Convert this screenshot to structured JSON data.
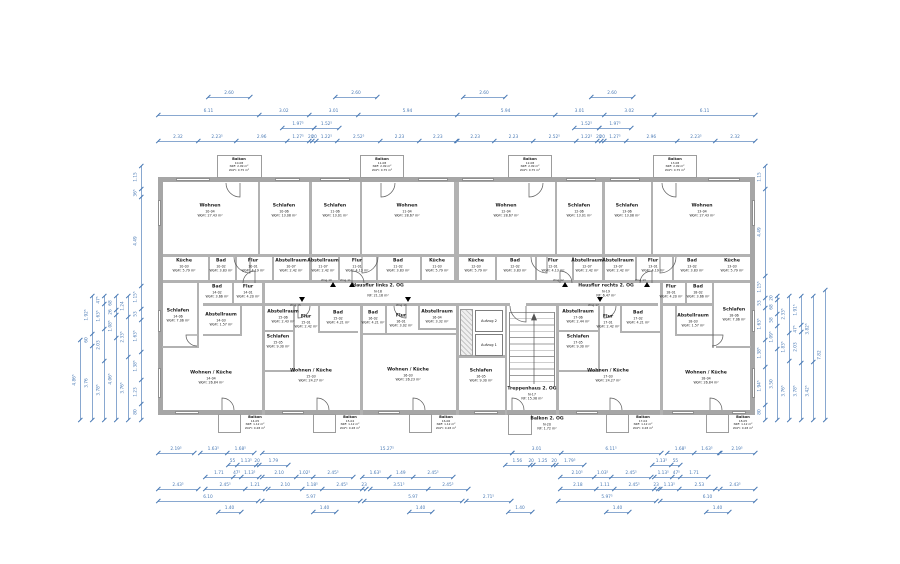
{
  "floor": "2. OG",
  "colors": {
    "dimension_blue": "#4a7ab5",
    "wall_gray": "#b2b2b2",
    "text_black": "#1b1b1b"
  },
  "elevators": {
    "top": "Aufzug 2",
    "bottom": "Aufzug 1"
  },
  "entrances": [
    "Wng 10",
    "Wng 11",
    "Wng 12",
    "Wng 13",
    "Wng 15",
    "Wng 16",
    "Wng 17"
  ],
  "rooms": [
    {
      "id": "w10",
      "name": "Wohnen",
      "no": "10-04",
      "area": "WoFl: 27.43 m²"
    },
    {
      "id": "s10",
      "name": "Schlafen",
      "no": "10-06",
      "area": "WoFl: 13.08 m²"
    },
    {
      "id": "k10",
      "name": "Küche",
      "no": "10-03",
      "area": "WoFl: 5.79 m²"
    },
    {
      "id": "b10",
      "name": "Bad",
      "no": "10-02",
      "area": "WoFl: 3.83 m²"
    },
    {
      "id": "f10",
      "name": "Flur",
      "no": "10-01",
      "area": "WoFl: 4.19 m²"
    },
    {
      "id": "a10",
      "name": "Abstellraum",
      "no": "10-07",
      "area": "WoFl: 2.42 m²"
    },
    {
      "id": "balt10",
      "name": "Balkon",
      "no": "10-08",
      "area": "NRF: 2.99 m²",
      "area2": "WoFl: 0.75 m²"
    },
    {
      "id": "s11",
      "name": "Schlafen",
      "no": "11-06",
      "area": "WoFl: 13.01 m²"
    },
    {
      "id": "w11",
      "name": "Wohnen",
      "no": "11-04",
      "area": "WoFl: 28.67 m²"
    },
    {
      "id": "a11",
      "name": "Abstellraum",
      "no": "11-07",
      "area": "WoFl: 2.42 m²"
    },
    {
      "id": "f11",
      "name": "Flur",
      "no": "11-01",
      "area": "WoFl: 4.13 m²"
    },
    {
      "id": "b11",
      "name": "Bad",
      "no": "11-02",
      "area": "WoFl: 3.83 m²"
    },
    {
      "id": "k11",
      "name": "Küche",
      "no": "11-03",
      "area": "WoFl: 5.79 m²"
    },
    {
      "id": "balt11",
      "name": "Balkon",
      "no": "11-08",
      "area": "NRF: 2.99 m²",
      "area2": "WoFl: 0.75 m²"
    },
    {
      "id": "w12",
      "name": "Wohnen",
      "no": "12-04",
      "area": "WoFl: 28.67 m²"
    },
    {
      "id": "s12",
      "name": "Schlafen",
      "no": "12-06",
      "area": "WoFl: 13.01 m²"
    },
    {
      "id": "k12",
      "name": "Küche",
      "no": "12-03",
      "area": "WoFl: 5.79 m²"
    },
    {
      "id": "b12",
      "name": "Bad",
      "no": "12-02",
      "area": "WoFl: 3.83 m²"
    },
    {
      "id": "f12",
      "name": "Flur",
      "no": "12-01",
      "area": "WoFl: 4.13 m²"
    },
    {
      "id": "a12",
      "name": "Abstellraum",
      "no": "12-07",
      "area": "WoFl: 2.42 m²"
    },
    {
      "id": "balt12",
      "name": "Balkon",
      "no": "12-08",
      "area": "NRF: 2.99 m²",
      "area2": "WoFl: 0.75 m²"
    },
    {
      "id": "s13",
      "name": "Schlafen",
      "no": "13-06",
      "area": "WoFl: 13.08 m²"
    },
    {
      "id": "w13",
      "name": "Wohnen",
      "no": "13-04",
      "area": "WoFl: 27.43 m²"
    },
    {
      "id": "a13",
      "name": "Abstellraum",
      "no": "13-07",
      "area": "WoFl: 2.42 m²"
    },
    {
      "id": "f13",
      "name": "Flur",
      "no": "13-01",
      "area": "WoFl: 4.19 m²"
    },
    {
      "id": "b13",
      "name": "Bad",
      "no": "13-02",
      "area": "WoFl: 3.83 m²"
    },
    {
      "id": "k13",
      "name": "Küche",
      "no": "13-03",
      "area": "WoFl: 5.79 m²"
    },
    {
      "id": "balt13",
      "name": "Balkon",
      "no": "13-08",
      "area": "NRF: 2.99 m²",
      "area2": "WoFl: 0.75 m²"
    },
    {
      "id": "s14",
      "name": "Schlafen",
      "no": "14-06",
      "area": "WoFl: 7.06 m²"
    },
    {
      "id": "b14",
      "name": "Bad",
      "no": "14-02",
      "area": "WoFl: 3.66 m²"
    },
    {
      "id": "f14",
      "name": "Flur",
      "no": "14-01",
      "area": "WoFl: 4.20 m²"
    },
    {
      "id": "a14",
      "name": "Abstellraum",
      "no": "14-03",
      "area": "WoFl: 1.57 m²"
    },
    {
      "id": "wk14",
      "name": "Wohnen / Küche",
      "no": "14-04",
      "area": "WoFl: 26.84 m²"
    },
    {
      "id": "balb14",
      "name": "Balkon",
      "no": "14-05",
      "area": "NRF: 1.12 m²",
      "area2": "WoFl: 0.28 m²"
    },
    {
      "id": "a15",
      "name": "Abstellraum",
      "no": "15-06",
      "area": "WoFl: 2.43 m²"
    },
    {
      "id": "f15",
      "name": "Flur",
      "no": "15-01",
      "area": "WoFl: 2.42 m²"
    },
    {
      "id": "b15",
      "name": "Bad",
      "no": "15-02",
      "area": "WoFl: 4.21 m²"
    },
    {
      "id": "s15",
      "name": "Schlafen",
      "no": "15-05",
      "area": "WoFl: 9.30 m²"
    },
    {
      "id": "wk15",
      "name": "Wohnen / Küche",
      "no": "15-03",
      "area": "WoFl: 24.27 m²"
    },
    {
      "id": "balb15",
      "name": "Balkon",
      "no": "15-04",
      "area": "NRF: 1.12 m²",
      "area2": "WoFl: 0.28 m²"
    },
    {
      "id": "b16",
      "name": "Bad",
      "no": "16-02",
      "area": "WoFl: 4.21 m²"
    },
    {
      "id": "f16",
      "name": "Flur",
      "no": "16-01",
      "area": "WoFl: 3.02 m²"
    },
    {
      "id": "a16",
      "name": "Abstellraum",
      "no": "16-04",
      "area": "WoFl: 3.32 m²"
    },
    {
      "id": "wk16",
      "name": "Wohnen / Küche",
      "no": "16-03",
      "area": "WoFl: 26.23 m²"
    },
    {
      "id": "s16",
      "name": "Schlafen",
      "no": "16-05",
      "area": "WoFl: 9.30 m²"
    },
    {
      "id": "balb16",
      "name": "Balkon",
      "no": "16-06",
      "area": "NRF: 1.12 m²",
      "area2": "WoFl: 0.28 m²"
    },
    {
      "id": "a17",
      "name": "Abstellraum",
      "no": "17-06",
      "area": "WoFl: 2.44 m²"
    },
    {
      "id": "f17",
      "name": "Flur",
      "no": "17-01",
      "area": "WoFl: 2.42 m²"
    },
    {
      "id": "b17",
      "name": "Bad",
      "no": "17-02",
      "area": "WoFl: 4.21 m²"
    },
    {
      "id": "s17",
      "name": "Schlafen",
      "no": "17-05",
      "area": "WoFl: 9.30 m²"
    },
    {
      "id": "wk17",
      "name": "Wohnen / Küche",
      "no": "17-03",
      "area": "WoFl: 24.27 m²"
    },
    {
      "id": "balb17",
      "name": "Balkon",
      "no": "17-04",
      "area": "NRF: 1.12 m²",
      "area2": "WoFl: 0.28 m²"
    },
    {
      "id": "f18",
      "name": "Flur",
      "no": "18-01",
      "area": "WoFl: 4.20 m²"
    },
    {
      "id": "b18",
      "name": "Bad",
      "no": "18-02",
      "area": "WoFl: 3.66 m²"
    },
    {
      "id": "a18",
      "name": "Abstellraum",
      "no": "18-03",
      "area": "WoFl: 1.57 m²"
    },
    {
      "id": "s18",
      "name": "Schlafen",
      "no": "18-06",
      "area": "WoFl: 7.06 m²"
    },
    {
      "id": "wk18",
      "name": "Wohnen / Küche",
      "no": "18-04",
      "area": "WoFl: 26.84 m²"
    },
    {
      "id": "balb18",
      "name": "Balkon",
      "no": "18-05",
      "area": "NRF: 1.12 m²",
      "area2": "WoFl: 0.28 m²"
    },
    {
      "id": "hfl",
      "name": "Hausflur links 2. OG",
      "no": "N-18",
      "area": "NF: 21.16 m²"
    },
    {
      "id": "hfr",
      "name": "Hausflur rechts 2. OG",
      "no": "N-19",
      "area": "NF: 6.47 m²"
    },
    {
      "id": "tr",
      "name": "Treppenhaus 2. OG",
      "no": "N-17",
      "area": "NF: 15.38 m²"
    },
    {
      "id": "b2og",
      "name": "Balkon 2. OG",
      "no": "N-20",
      "area": "NF: 1.72 m²"
    }
  ],
  "dimensions": {
    "top": [
      [
        "2.60"
      ],
      [
        "2.60"
      ],
      [
        "2.60"
      ],
      [
        "2.60"
      ],
      [
        "6.11",
        "3.02",
        "3.01",
        "5.94",
        "5.94",
        "3.01",
        "3.02",
        "6.11"
      ],
      [
        "1.97⁵"
      ],
      [
        "1.52⁵"
      ],
      [
        "1.52⁵"
      ],
      [
        "1.97⁵"
      ],
      [
        "2.32",
        "2.23⁵",
        "2.96",
        "1.27⁵",
        "20",
        "20",
        "1.22⁵",
        "2.52⁵",
        "2.23",
        "2.23"
      ],
      [
        "2.23",
        "2.23",
        "2.52⁵",
        "1.22⁵",
        "20",
        "20",
        "1.27⁵",
        "2.96",
        "2.23⁵",
        "2.32"
      ]
    ],
    "bottom": [
      [
        "2.19⁵"
      ],
      [
        "1.63⁵",
        "1.68⁵"
      ],
      [
        "15.27⁵"
      ],
      [
        "3.01",
        "6.11⁵"
      ],
      [
        "1.68⁵",
        "1.63⁵"
      ],
      [
        "2.19⁵"
      ],
      [
        "55",
        "1.13⁵",
        "20",
        "1.79"
      ],
      [
        "1.56",
        "20",
        "1.25",
        "20",
        "1.79⁵"
      ],
      [
        "1.13⁵",
        "55"
      ],
      [
        "1.71",
        "47⁵",
        "1.13⁵"
      ],
      [
        "2.10",
        "1.02⁵",
        "2.45⁵"
      ],
      [
        "1.63⁵",
        "1.49",
        "2.45⁵"
      ],
      [
        "2.10⁵",
        "1.03⁵",
        "2.45⁵"
      ],
      [
        "1.13⁵",
        "47⁵",
        "1.71"
      ],
      [
        "2.43⁵"
      ],
      [
        "2.45⁵",
        "1.21"
      ],
      [
        "2.10",
        "1.18⁵",
        "2.45⁵",
        "23"
      ],
      [
        "3.51⁵",
        "2.45⁵"
      ],
      [
        "2.18",
        "1.11",
        "2.45⁵",
        "23"
      ],
      [
        "1.13⁵",
        "2.53"
      ],
      [
        "2.43⁵"
      ],
      [
        "6.10"
      ],
      [
        "5.97"
      ],
      [
        "5.97"
      ],
      [
        "2.71⁵"
      ],
      [
        "5.97⁵"
      ],
      [
        "6.10"
      ],
      [
        "1.40"
      ],
      [
        "1.40"
      ],
      [
        "1.40"
      ],
      [
        "1.40"
      ],
      [
        "1.40"
      ],
      [
        "1.40"
      ]
    ],
    "left": [
      [
        "1.15",
        "36⁵",
        "4.49",
        "1.15⁵",
        "53",
        "1.63⁵",
        "1.38⁵",
        "1.23",
        "80"
      ],
      [
        "1.24",
        "2.33⁵",
        "3.76⁵"
      ],
      [
        "68",
        "26",
        "1.08⁵",
        "4.06⁵"
      ],
      [
        "47⁵",
        "1.63⁵",
        "2.03",
        "3.78⁵"
      ],
      [
        "1.92⁵",
        "60",
        "3.76"
      ],
      [
        "4.86⁵"
      ]
    ],
    "right": [
      [
        "1.15",
        "4.49",
        "1.15⁵",
        "53",
        "1.63⁵",
        "1.38⁵",
        "1.94⁵",
        "80"
      ],
      [
        "20",
        "68",
        "58",
        "1.09⁵",
        "3.50"
      ],
      [
        "2.33⁵",
        "1.83⁵",
        "3.76⁵"
      ],
      [
        "1.91⁵",
        "47⁵",
        "2.03",
        "3.78⁵"
      ],
      [
        "3.82⁵",
        "3.42⁵"
      ],
      [
        "7.82"
      ]
    ]
  }
}
